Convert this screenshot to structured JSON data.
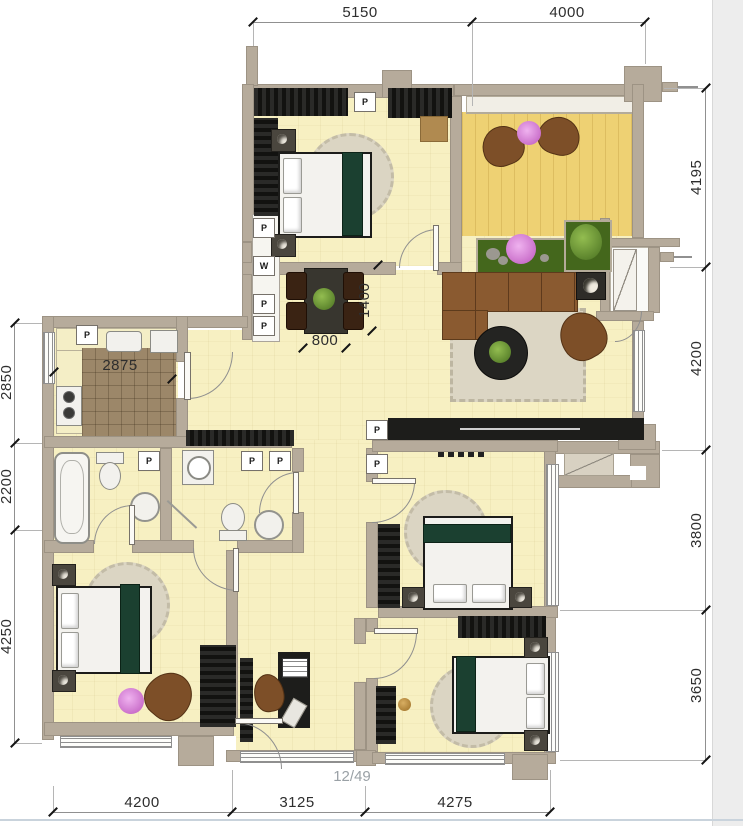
{
  "page": {
    "indicator": "12/49"
  },
  "dims": {
    "top": [
      "5150",
      "4000"
    ],
    "right": [
      "4195",
      "4200",
      "3800",
      "3650"
    ],
    "left": [
      "2850",
      "2200",
      "4250"
    ],
    "bottom": [
      "4200",
      "3125",
      "4275"
    ],
    "interior": {
      "kitchen_width": "2875",
      "dining_depth": "1400",
      "dining_width": "800"
    }
  },
  "markers": {
    "pipe": "P",
    "water": "W"
  },
  "colors": {
    "wall": "#b6ab9b",
    "floor": "#f7f0c2",
    "balcony_floor": "#eed173",
    "kitchen_tile": "#9c8769",
    "wardrobe": "#1d1d1b",
    "sofa_brown": "#8a5a30",
    "bed_accent_green": "#1b4030",
    "planter_green": "#44671c",
    "flower_pink": "#d98fd9",
    "dim_text": "#2e2e2e"
  }
}
